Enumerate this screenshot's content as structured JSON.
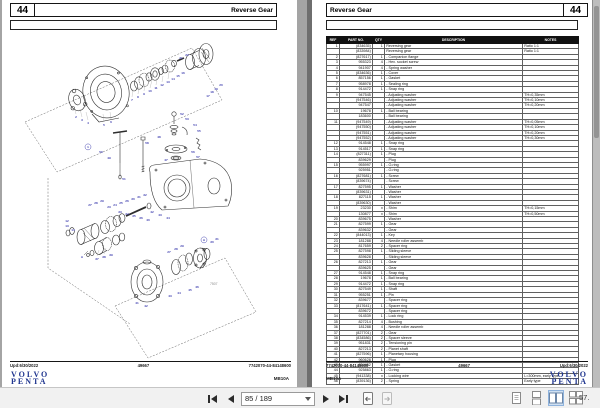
{
  "brand": {
    "logo_line1": "VOLVO",
    "logo_line2": "PENTA"
  },
  "colors": {
    "label_blue": "#3a3aad",
    "logo_blue": "#20368f",
    "table_header_bg": "#111111",
    "selected_view_bg": "#cfe0f2"
  },
  "left_page": {
    "page_number": "44",
    "title": "Reverse Gear",
    "footer": {
      "updated": "Upd:6/30/2022",
      "code": "49667",
      "doc": "7742070-44-84148600",
      "model": "MB10A"
    },
    "diagram": {
      "figure_number": "7507",
      "labels": [
        [
          "2",
          76,
          118
        ],
        [
          "3",
          82,
          121
        ],
        [
          "4",
          88,
          124
        ],
        [
          "5",
          104,
          126
        ],
        [
          "6",
          111,
          123
        ],
        [
          "1",
          88,
          148,
          "c"
        ],
        [
          "7",
          132,
          101
        ],
        [
          "8",
          138,
          98
        ],
        [
          "9",
          144,
          95
        ],
        [
          "10",
          150,
          92
        ],
        [
          "11",
          156,
          89
        ],
        [
          "12",
          162,
          86
        ],
        [
          "13",
          168,
          83
        ],
        [
          "14",
          173,
          80
        ],
        [
          "15",
          178,
          77
        ],
        [
          "16",
          183,
          74
        ],
        [
          "21",
          181,
          59
        ],
        [
          "22",
          187,
          56
        ],
        [
          "17",
          208,
          97
        ],
        [
          "18",
          212,
          93
        ],
        [
          "19",
          216,
          90
        ],
        [
          "20",
          221,
          86
        ],
        [
          "50",
          101,
          153
        ],
        [
          "49",
          109,
          159
        ],
        [
          "51",
          124,
          180
        ],
        [
          "58",
          147,
          144
        ],
        [
          "48",
          159,
          138
        ],
        [
          "52",
          182,
          115
        ],
        [
          "53",
          187,
          120
        ],
        [
          "54",
          195,
          126
        ],
        [
          "55",
          199,
          132
        ],
        [
          "56",
          193,
          153
        ],
        [
          "57",
          198,
          158
        ],
        [
          "47",
          166,
          161
        ],
        [
          "42",
          152,
          213
        ],
        [
          "43",
          160,
          216
        ],
        [
          "44",
          168,
          219
        ],
        [
          "12",
          67,
          222
        ],
        [
          "13",
          67,
          227
        ],
        [
          "14",
          73,
          231
        ],
        [
          "27",
          90,
          206
        ],
        [
          "28",
          96,
          204
        ],
        [
          "29",
          102,
          202
        ],
        [
          "23",
          109,
          208
        ],
        [
          "24",
          115,
          206
        ],
        [
          "25",
          121,
          204
        ],
        [
          "26",
          127,
          202
        ],
        [
          "30",
          133,
          200
        ],
        [
          "31",
          139,
          198
        ],
        [
          "32",
          145,
          196
        ],
        [
          "33",
          120,
          213
        ],
        [
          "34",
          127,
          215
        ],
        [
          "35",
          134,
          217
        ],
        [
          "36",
          141,
          219
        ],
        [
          "40",
          148,
          221
        ],
        [
          "37",
          97,
          260
        ],
        [
          "38",
          104,
          258
        ],
        [
          "39",
          111,
          256
        ],
        [
          "A",
          82,
          258
        ],
        [
          "27",
          169,
          253
        ],
        [
          "28",
          176,
          250
        ],
        [
          "29",
          182,
          247
        ],
        [
          "30",
          212,
          243
        ],
        [
          "31",
          217,
          240
        ],
        [
          "A",
          204,
          241,
          "c"
        ],
        [
          "41",
          137,
          304
        ],
        [
          "42",
          146,
          307
        ],
        [
          "43",
          170,
          297
        ],
        [
          "44",
          179,
          294
        ],
        [
          "45",
          190,
          291
        ],
        [
          "46",
          197,
          288
        ]
      ]
    }
  },
  "right_page": {
    "page_number": "44",
    "title": "Reverse Gear",
    "footer": {
      "doc": "7742070-44-84148600",
      "code": "49667",
      "updated": "Upd:6/30/2022",
      "model": "MB10A"
    },
    "table": {
      "headers": [
        "REF",
        "PART NO.",
        "QTY",
        "DESCRIPTION",
        "NOTES"
      ],
      "rows": [
        [
          "1",
          "(834635)",
          "1",
          "Reversing gear",
          "Ratio 1:1"
        ],
        [
          "",
          "(833984)",
          "",
          "Reversing gear",
          "Ratio 1:1"
        ],
        [
          "2",
          "(827617)",
          "1",
          "- Companion flange",
          ""
        ],
        [
          "3",
          "955323",
          "4",
          "- Hex. socket screw",
          ""
        ],
        [
          "4",
          "941907",
          "4",
          "- Spring washer",
          ""
        ],
        [
          "5",
          "(834636)",
          "1",
          "- Cover",
          ""
        ],
        [
          "6",
          "857156",
          "1",
          "- Gasket",
          ""
        ],
        [
          "7",
          "958978",
          "1",
          "- Sealing ring",
          ""
        ],
        [
          "8",
          "914472",
          "1",
          "- Snap ring",
          ""
        ],
        [
          "9",
          "947545",
          "",
          "- Adjusting washer",
          "TH=0,35mm"
        ],
        [
          "",
          "(947546)",
          "",
          "- Adjusting washer",
          "TH=0,10mm"
        ],
        [
          "",
          "947547",
          "",
          "- Adjusting washer",
          "TH=0,20mm"
        ],
        [
          "10",
          "19678",
          "1",
          "- Ball bearing",
          ""
        ],
        [
          "",
          "183600",
          "",
          "- Ball bearing",
          ""
        ],
        [
          "11",
          "(947549)",
          "",
          "- Adjusting washer",
          "TH=0,05mm"
        ],
        [
          "",
          "(947550)",
          "",
          "- Adjusting washer",
          "TH=0,10mm"
        ],
        [
          "",
          "(947551)",
          "",
          "- Adjusting washer",
          "TH=0,20mm"
        ],
        [
          "",
          "(947552)",
          "",
          "- Adjusting washer",
          "TH=0,30mm"
        ],
        [
          "12",
          "914548",
          "1",
          "- Snap ring",
          ""
        ],
        [
          "13",
          "914517",
          "1",
          "- Snap ring",
          ""
        ],
        [
          "14",
          "(827311)",
          "1",
          "- Plug",
          ""
        ],
        [
          "",
          "839629",
          "",
          "- Plug",
          ""
        ],
        [
          "15",
          "955997",
          "1",
          "- O-ring",
          ""
        ],
        [
          "",
          "925951",
          "",
          "- O-ring",
          ""
        ],
        [
          "16",
          "(827681)",
          "1",
          "- Screw",
          ""
        ],
        [
          "",
          "(839674)",
          "",
          "- Screw",
          ""
        ],
        [
          "17",
          "827595",
          "1",
          "- Washer",
          ""
        ],
        [
          "",
          "(839631)",
          "",
          "- Washer",
          ""
        ],
        [
          "18",
          "827115",
          "1",
          "- Washer",
          ""
        ],
        [
          "",
          "(839630)",
          "",
          "- Washer",
          ""
        ],
        [
          "19",
          "23230",
          "x",
          "- Shim",
          "TH=0,15mm"
        ],
        [
          "",
          "130877",
          "x",
          "- Shim",
          "TH=0,50mm"
        ],
        [
          "20",
          "839675",
          "",
          "- Washer",
          ""
        ],
        [
          "21",
          "827599",
          "1",
          "- Gear",
          ""
        ],
        [
          "",
          "839632",
          "",
          "- Gear",
          ""
        ],
        [
          "22",
          "(844013)",
          "1",
          "- Key",
          ""
        ],
        [
          "23",
          "181288",
          "4",
          "- Needle roller assemb",
          ""
        ],
        [
          "24",
          "817659",
          "2",
          "- Spacer ring",
          ""
        ],
        [
          "25",
          "827598",
          "1",
          "- Sliding sleeve",
          ""
        ],
        [
          "",
          "839628",
          "",
          "- Sliding sleeve",
          ""
        ],
        [
          "26",
          "827213",
          "1",
          "- Gear",
          ""
        ],
        [
          "",
          "839625",
          "",
          "- Gear",
          ""
        ],
        [
          "27",
          "914548",
          "1",
          "- Snap ring",
          ""
        ],
        [
          "28",
          "19678",
          "1",
          "- Ball bearing",
          ""
        ],
        [
          "29",
          "914472",
          "1",
          "- Snap ring",
          ""
        ],
        [
          "30",
          "827549",
          "1",
          "- Shaft",
          ""
        ],
        [
          "31",
          "955251",
          "1",
          "- Pin",
          ""
        ],
        [
          "32",
          "839677",
          "",
          "- Spacer ring",
          ""
        ],
        [
          "33",
          "(817641)",
          "1",
          "- Spacer ring",
          ""
        ],
        [
          "",
          "839672",
          "",
          "- Spacer ring",
          ""
        ],
        [
          "34",
          "914539",
          "1",
          "- Lock ring",
          ""
        ],
        [
          "35",
          "827214",
          "4",
          "- Bushing",
          ""
        ],
        [
          "36",
          "181288",
          "4",
          "- Needle roller assemb",
          ""
        ],
        [
          "37",
          "(827701)",
          "2",
          "- Gear",
          ""
        ],
        [
          "38",
          "(834586)",
          "2",
          "- Spacer sleeve",
          ""
        ],
        [
          "39",
          "951831",
          "2",
          "- Tensioning pin",
          ""
        ],
        [
          "40",
          "827213",
          "2",
          "- Planet shaft",
          ""
        ],
        [
          "41",
          "(827596)",
          "1",
          "- Planetary housing",
          ""
        ],
        [
          "42",
          "960628",
          "1",
          "- Plug",
          ""
        ],
        [
          "43",
          "834452",
          "1",
          "- Gasket",
          ""
        ],
        [
          "44",
          "925863",
          "1",
          "- O-ring",
          ""
        ],
        [
          "45",
          "(941338)",
          "x",
          "- Locking wire",
          "L=300mm, early type"
        ],
        [
          "46",
          "(839136)",
          "2",
          "- Spring",
          "Early type"
        ]
      ]
    }
  },
  "toolbar": {
    "page_indicator": "85 / 189",
    "zoom": "57.",
    "icons": [
      "first-page",
      "previous-page",
      "next-page",
      "last-page",
      "previous-view",
      "next-view",
      "single-page-view",
      "continuous-view",
      "two-page-view",
      "two-page-continuous-view"
    ]
  }
}
